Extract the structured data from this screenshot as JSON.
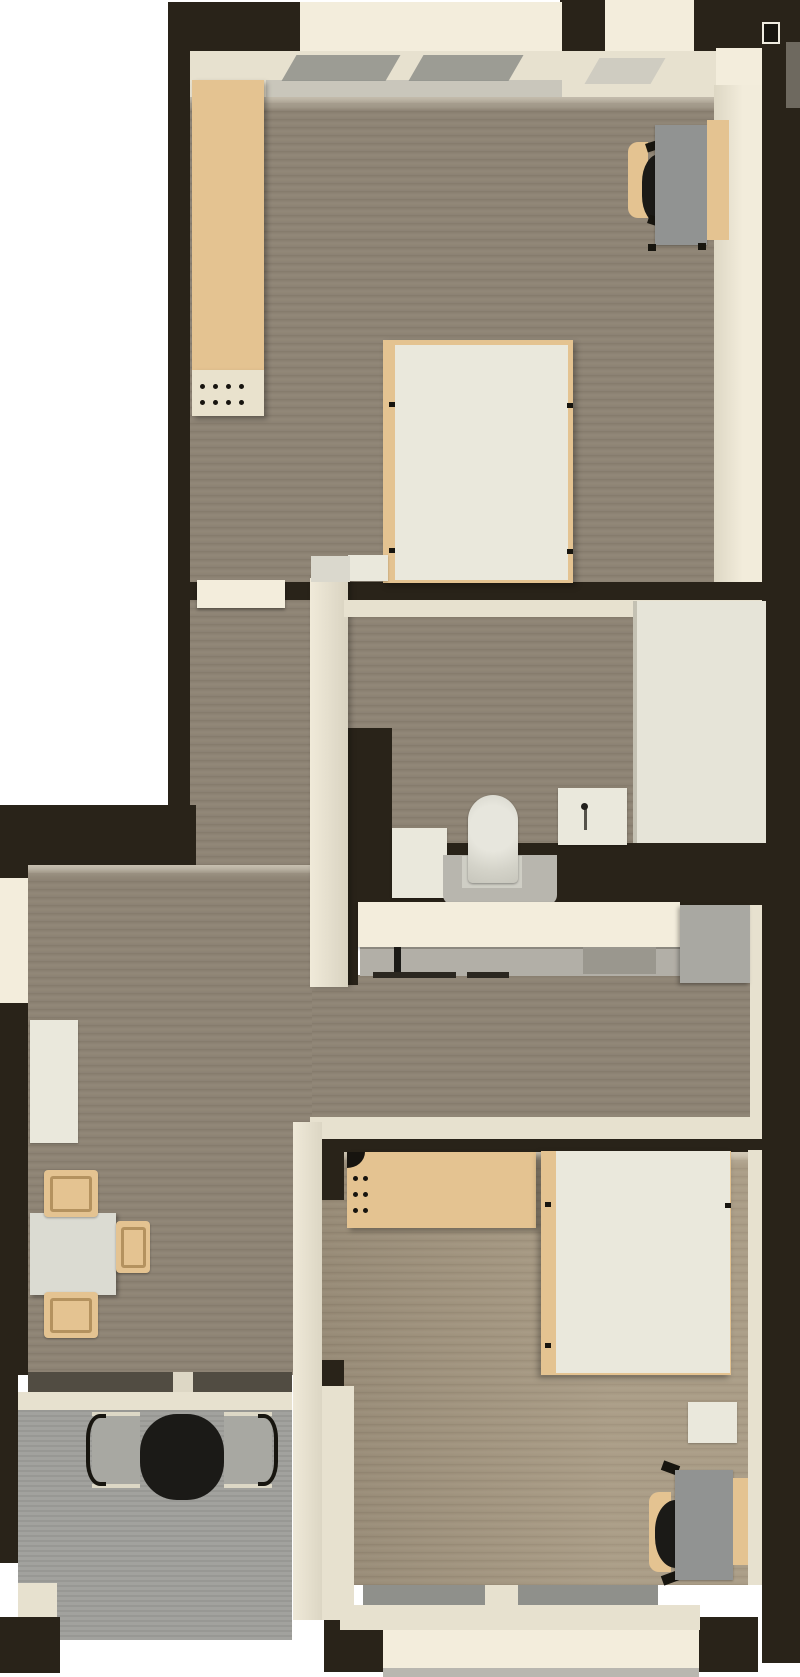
{
  "scene": {
    "type": "3d-floor-plan-top-view",
    "description": "Top-down 3D rendering of a two-bedroom apartment with balcony",
    "rooms": [
      {
        "name": "bedroom-top",
        "furniture": [
          "wardrobe",
          "desk",
          "office-chair",
          "double-bed",
          "nightstand",
          "dresser"
        ]
      },
      {
        "name": "hallway",
        "furniture": []
      },
      {
        "name": "bathroom",
        "furniture": [
          "washing-machine",
          "toilet",
          "sink",
          "shower"
        ]
      },
      {
        "name": "kitchen",
        "furniture": [
          "counter",
          "built-in-appliances",
          "fridge"
        ]
      },
      {
        "name": "living-room",
        "furniture": [
          "sideboard",
          "dining-table",
          "dining-chairs"
        ]
      },
      {
        "name": "balcony",
        "furniture": [
          "round-table",
          "outdoor-chairs"
        ]
      },
      {
        "name": "bedroom-bottom",
        "furniture": [
          "wardrobe",
          "double-bed",
          "nightstand",
          "desk",
          "office-chair"
        ]
      }
    ]
  },
  "icons": {
    "door_marker": "door-icon"
  },
  "palette": {
    "bg": "#ffffff",
    "wall": "#292319",
    "wall_soft": "#332d24",
    "cream": "#e7e1cf",
    "cream_bright": "#f3eddc",
    "wood": "#8c8273",
    "wood_light": "#9d907b",
    "glass": "#8f908b",
    "pane": "#8e8f8a",
    "concrete": "#9e9e9a",
    "tan": "#e4c391",
    "white_furn": "#eae8dc",
    "gray_desk": "#919392",
    "gray_fridge": "#a9a8a2",
    "gray_appl": "#b2afa7",
    "gray_appl_dark": "#9a978e",
    "platform": "#b8b6ae",
    "black": "#1b1a17"
  }
}
